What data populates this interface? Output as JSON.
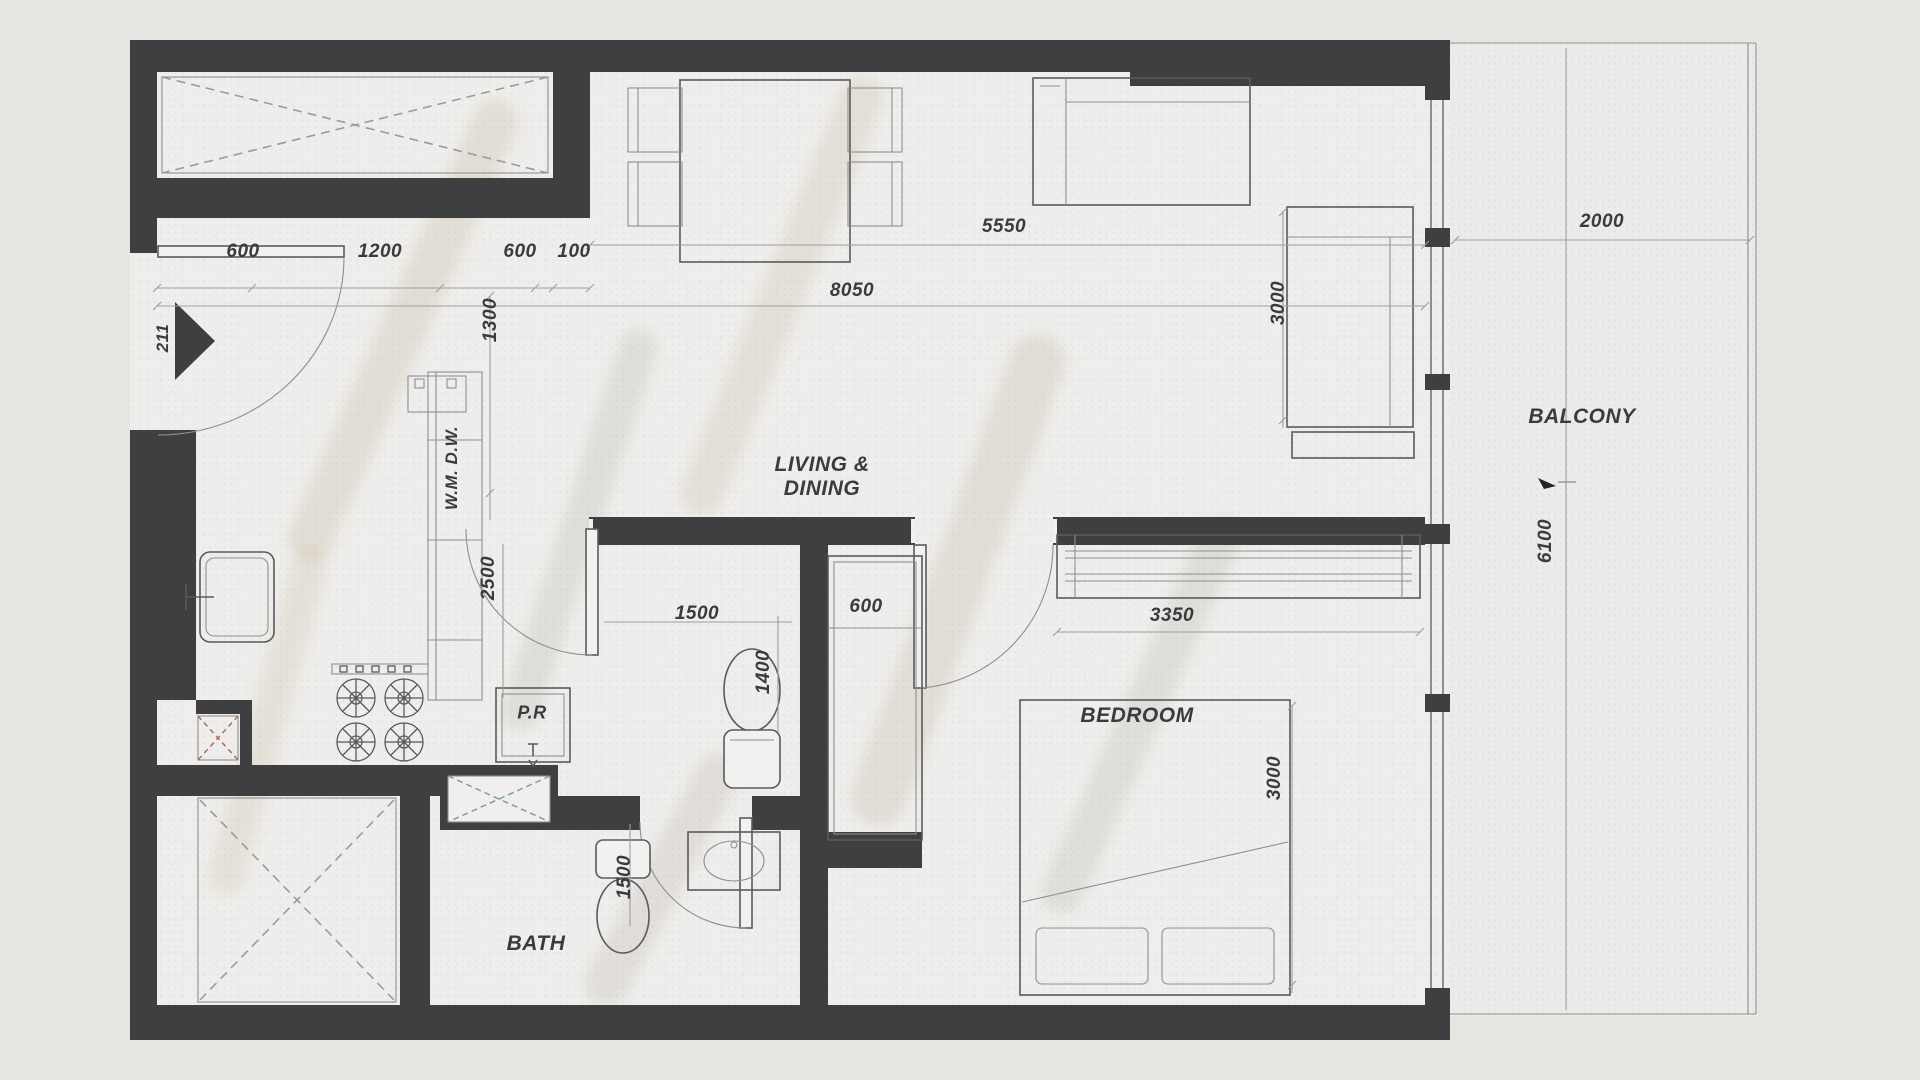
{
  "document": {
    "type": "apartment-floor-plan",
    "unit_type": "1 Bedroom Apartment"
  },
  "colors": {
    "wall": "#3f3e41",
    "ink": "#3b3b3d",
    "line": "#5a5a5c",
    "linesoft": "#8f8f91",
    "dimline": "#9f9e9c",
    "xgray": "#9b9b99",
    "xred": "#a5705f",
    "xteal": "#7fa098",
    "floor": "#efeeec",
    "balcony_floor": "#ecebe9"
  },
  "rooms": [
    {
      "name": "room-label-living-dining",
      "text": "LIVING &\nDINING",
      "x": 822,
      "y": 477,
      "rot": false,
      "size": 21
    },
    {
      "name": "room-label-bedroom",
      "text": "BEDROOM",
      "x": 1137,
      "y": 716,
      "rot": false,
      "size": 21
    },
    {
      "name": "room-label-bath",
      "text": "BATH",
      "x": 536,
      "y": 944,
      "rot": false,
      "size": 21
    },
    {
      "name": "room-label-balcony",
      "text": "BALCONY",
      "x": 1582,
      "y": 417,
      "rot": false,
      "size": 21
    },
    {
      "name": "room-label-powder-room",
      "text": "P.R",
      "x": 532,
      "y": 713,
      "rot": false,
      "size": 18
    },
    {
      "name": "appliance-label-wm-dw",
      "text": "W.M. D.W.",
      "x": 452,
      "y": 468,
      "rot": true,
      "size": 17
    }
  ],
  "dimensions": [
    {
      "name": "dim-600-entry",
      "text": "600",
      "x": 243,
      "y": 252,
      "rot": false,
      "size": 19
    },
    {
      "name": "dim-1200-kitchen",
      "text": "1200",
      "x": 380,
      "y": 252,
      "rot": false,
      "size": 19
    },
    {
      "name": "dim-600-counter",
      "text": "600",
      "x": 520,
      "y": 252,
      "rot": false,
      "size": 19
    },
    {
      "name": "dim-100-wall",
      "text": "100",
      "x": 574,
      "y": 252,
      "rot": false,
      "size": 19
    },
    {
      "name": "dim-1300-corridor",
      "text": "1300",
      "x": 491,
      "y": 320,
      "rot": true,
      "size": 19
    },
    {
      "name": "dim-211-entry",
      "text": "211",
      "x": 163,
      "y": 338,
      "rot": true,
      "size": 17
    },
    {
      "name": "dim-8050-living",
      "text": "8050",
      "x": 852,
      "y": 291,
      "rot": false,
      "size": 19
    },
    {
      "name": "dim-5550-living",
      "text": "5550",
      "x": 1004,
      "y": 227,
      "rot": false,
      "size": 19
    },
    {
      "name": "dim-2000-balcony",
      "text": "2000",
      "x": 1602,
      "y": 222,
      "rot": false,
      "size": 19
    },
    {
      "name": "dim-3000-sofa",
      "text": "3000",
      "x": 1279,
      "y": 303,
      "rot": true,
      "size": 19
    },
    {
      "name": "dim-2500-kitchen",
      "text": "2500",
      "x": 489,
      "y": 578,
      "rot": true,
      "size": 19
    },
    {
      "name": "dim-1500-hall",
      "text": "1500",
      "x": 697,
      "y": 614,
      "rot": false,
      "size": 19
    },
    {
      "name": "dim-1400-pr",
      "text": "1400",
      "x": 764,
      "y": 672,
      "rot": true,
      "size": 19
    },
    {
      "name": "dim-600-closet",
      "text": "600",
      "x": 866,
      "y": 607,
      "rot": false,
      "size": 19
    },
    {
      "name": "dim-3350-wardrobe",
      "text": "3350",
      "x": 1172,
      "y": 616,
      "rot": false,
      "size": 19
    },
    {
      "name": "dim-1500-bath",
      "text": "1500",
      "x": 625,
      "y": 877,
      "rot": true,
      "size": 19
    },
    {
      "name": "dim-3000-bedroom",
      "text": "3000",
      "x": 1275,
      "y": 778,
      "rot": true,
      "size": 19
    },
    {
      "name": "dim-6100-balcony",
      "text": "6100",
      "x": 1546,
      "y": 541,
      "rot": true,
      "size": 19
    }
  ]
}
